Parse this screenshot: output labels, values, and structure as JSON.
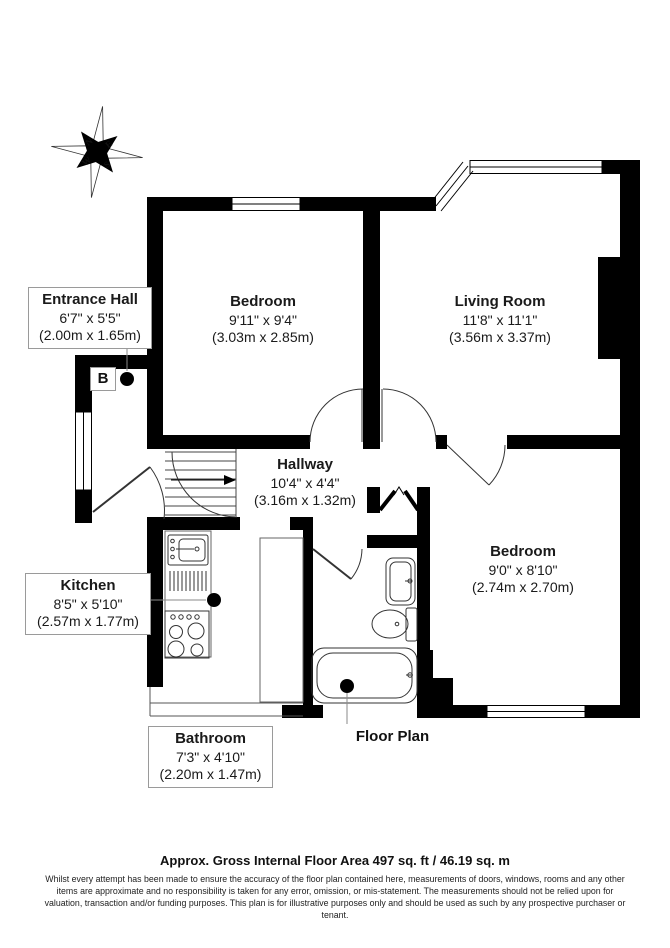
{
  "rooms": [
    {
      "id": "entrance-hall",
      "name": "Entrance Hall",
      "imperial": "6'7\" x 5'5\"",
      "metric": "(2.00m x 1.65m)"
    },
    {
      "id": "bedroom-1",
      "name": "Bedroom",
      "imperial": "9'11\" x 9'4\"",
      "metric": "(3.03m x 2.85m)"
    },
    {
      "id": "living-room",
      "name": "Living Room",
      "imperial": "11'8\" x 11'1\"",
      "metric": "(3.56m x 3.37m)"
    },
    {
      "id": "hallway",
      "name": "Hallway",
      "imperial": "10'4\" x 4'4\"",
      "metric": "(3.16m x 1.32m)"
    },
    {
      "id": "kitchen",
      "name": "Kitchen",
      "imperial": "8'5\" x 5'10\"",
      "metric": "(2.57m x 1.77m)"
    },
    {
      "id": "bedroom-2",
      "name": "Bedroom",
      "imperial": "9'0\" x 8'10\"",
      "metric": "(2.74m x 2.70m)"
    },
    {
      "id": "bathroom",
      "name": "Bathroom",
      "imperial": "7'3\" x 4'10\"",
      "metric": "(2.20m x 1.47m)"
    }
  ],
  "annotations": {
    "boiler_label": "B",
    "plan_title": "Floor Plan"
  },
  "compass": {
    "n": "N",
    "e": "E",
    "s": "S",
    "w": "W"
  },
  "footer": {
    "area_line": "Approx. Gross Internal Floor Area 497 sq. ft / 46.19 sq. m",
    "disclaimer": "Whilst every attempt has been made to ensure the accuracy of the floor plan contained here, measurements of doors, windows, rooms and any other items are approximate and no responsibility is taken for any error, omission, or mis-statement. The measurements should not be relied upon for valuation, transaction and/or funding purposes. This plan is for illustrative purposes only and should be used as such by any prospective purchaser or tenant."
  },
  "colors": {
    "wall": "#000000",
    "background": "#ffffff",
    "label_border": "#9a9a9a"
  }
}
